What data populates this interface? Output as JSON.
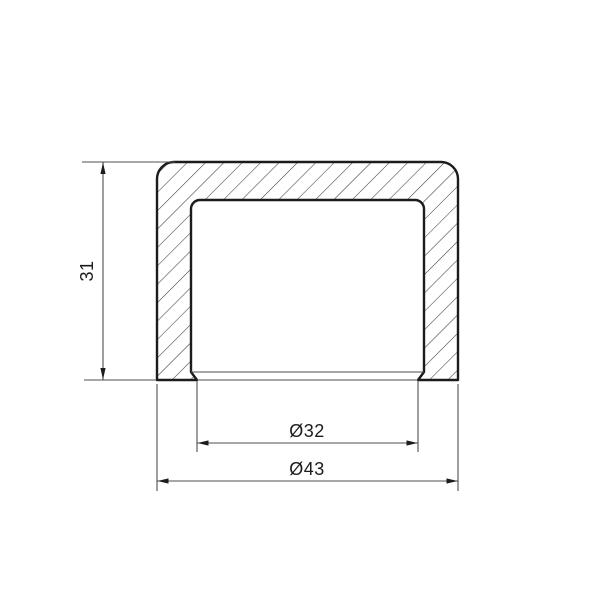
{
  "drawing": {
    "type": "technical-section-view",
    "part": "pipe-end-cap-cross-section",
    "dimensions": {
      "height": {
        "label": "31",
        "value": 31,
        "orientation": "vertical"
      },
      "inner_diameter": {
        "label": "Ø32",
        "value": 32,
        "orientation": "horizontal"
      },
      "outer_diameter": {
        "label": "Ø43",
        "value": 43,
        "orientation": "horizontal"
      }
    },
    "colors": {
      "background": "#ffffff",
      "outline": "#1c1c1c",
      "hatch": "#3c3c3c",
      "dimension": "#4f4f4f",
      "text": "#1c1c1c"
    }
  }
}
